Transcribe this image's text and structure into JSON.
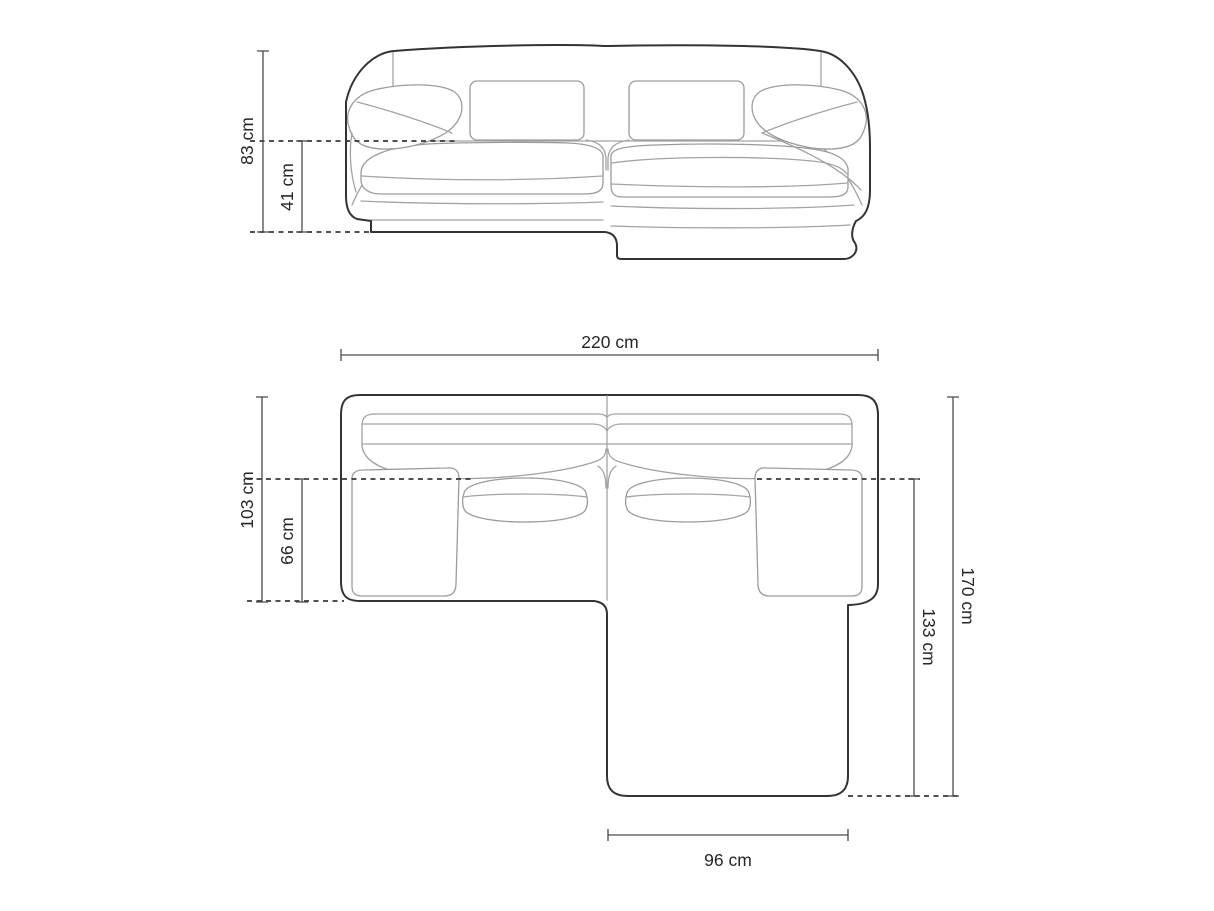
{
  "measurements": {
    "height_total": "83 cm",
    "seat_height": "41 cm",
    "width_total": "220 cm",
    "body_depth": "103 cm",
    "seat_depth": "66 cm",
    "total_depth": "170 cm",
    "chaise_depth": "133 cm",
    "chaise_width": "96 cm"
  },
  "unit": "cm",
  "colors": {
    "background": "#ffffff",
    "outline_dark": "#333333",
    "outline_light": "#a3a3a3",
    "dimension_line": "#4a4a4a",
    "dashed_line": "#383838",
    "label_text": "#262626"
  }
}
